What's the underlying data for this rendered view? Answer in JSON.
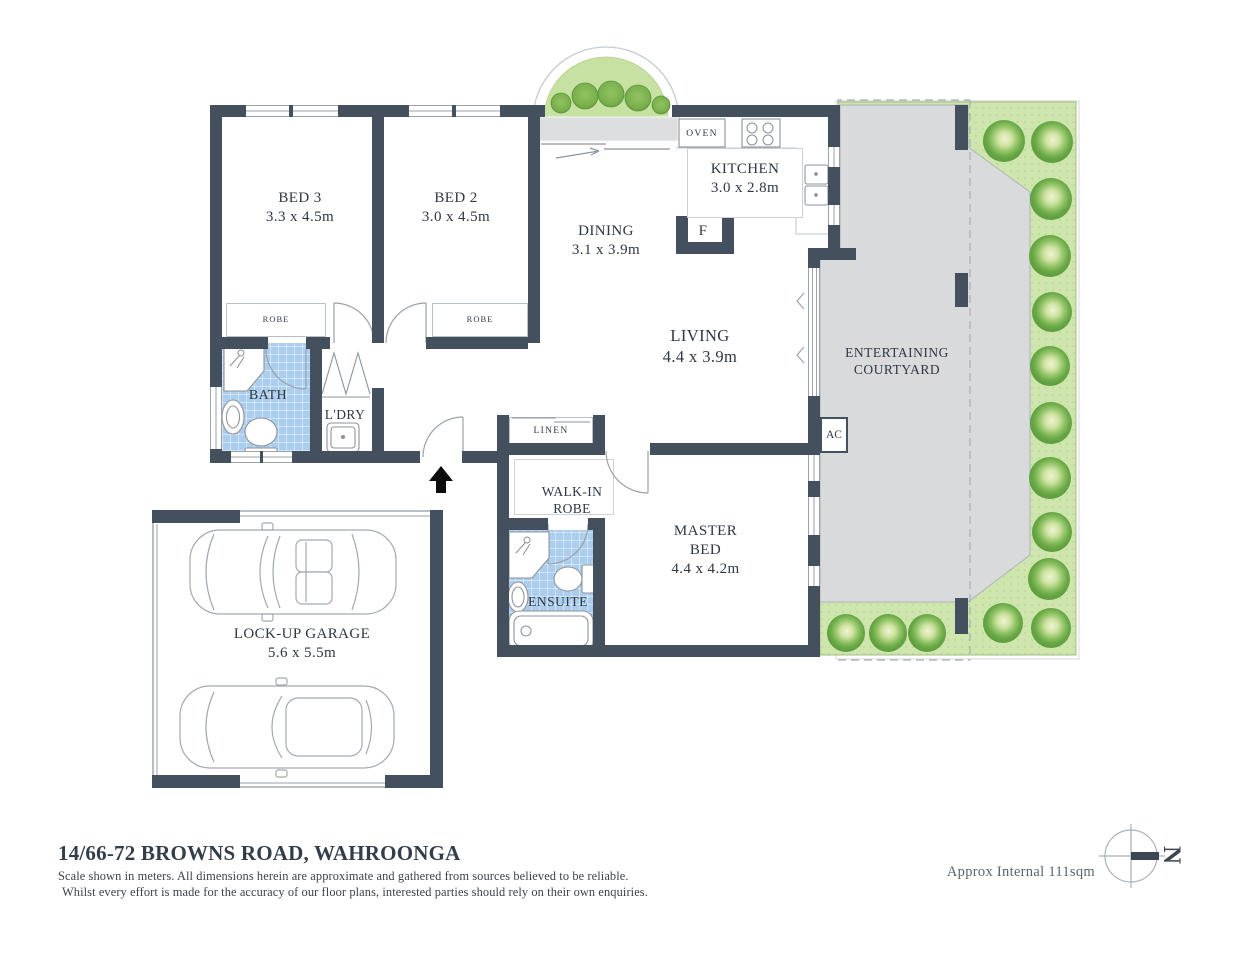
{
  "floorplan": {
    "rooms": {
      "bed3": {
        "name": "BED 3",
        "dims": "3.3 x 4.5m"
      },
      "bed2": {
        "name": "BED 2",
        "dims": "3.0 x 4.5m"
      },
      "dining": {
        "name": "DINING",
        "dims": "3.1 x 3.9m"
      },
      "kitchen": {
        "name": "KITCHEN",
        "dims": "3.0 x 2.8m"
      },
      "living": {
        "name": "LIVING",
        "dims": "4.4 x 3.9m"
      },
      "master_bed": {
        "line1": "MASTER",
        "line2": "BED",
        "dims": "4.4 x 4.2m"
      },
      "garage": {
        "name": "LOCK-UP GARAGE",
        "dims": "5.6 x 5.5m"
      },
      "courtyard": {
        "line1": "ENTERTAINING",
        "line2": "COURTYARD"
      },
      "walk_in_robe": {
        "line1": "WALK-IN",
        "line2": "ROBE"
      },
      "bath": {
        "name": "BATH"
      },
      "laundry": {
        "name": "L'DRY"
      },
      "linen": {
        "name": "LINEN"
      },
      "ensuite": {
        "name": "ENSUITE"
      },
      "robe_bed3": {
        "name": "ROBE"
      },
      "robe_bed2": {
        "name": "ROBE"
      },
      "oven": {
        "name": "OVEN"
      },
      "fridge": {
        "name": "F"
      },
      "ac": {
        "name": "AC"
      }
    },
    "compass": {
      "north_label": "N"
    },
    "footer": {
      "title": "14/66-72 BROWNS ROAD, WAHROONGA",
      "disclaimer_line1": "Scale shown in meters. All dimensions herein are approximate and gathered from sources believed to be  reliable.",
      "disclaimer_line2": "Whilst every effort is made for the accuracy of our floor plans, interested parties should rely on their own enquiries.",
      "area_note": "Approx Internal 111sqm"
    },
    "colors": {
      "wall": "#45505e",
      "wet_area": "#abcdee",
      "courtyard_paving": "#d8dadc",
      "garden": "#cfe5ae",
      "bush": "#68a845",
      "text": "#2e3743"
    }
  }
}
